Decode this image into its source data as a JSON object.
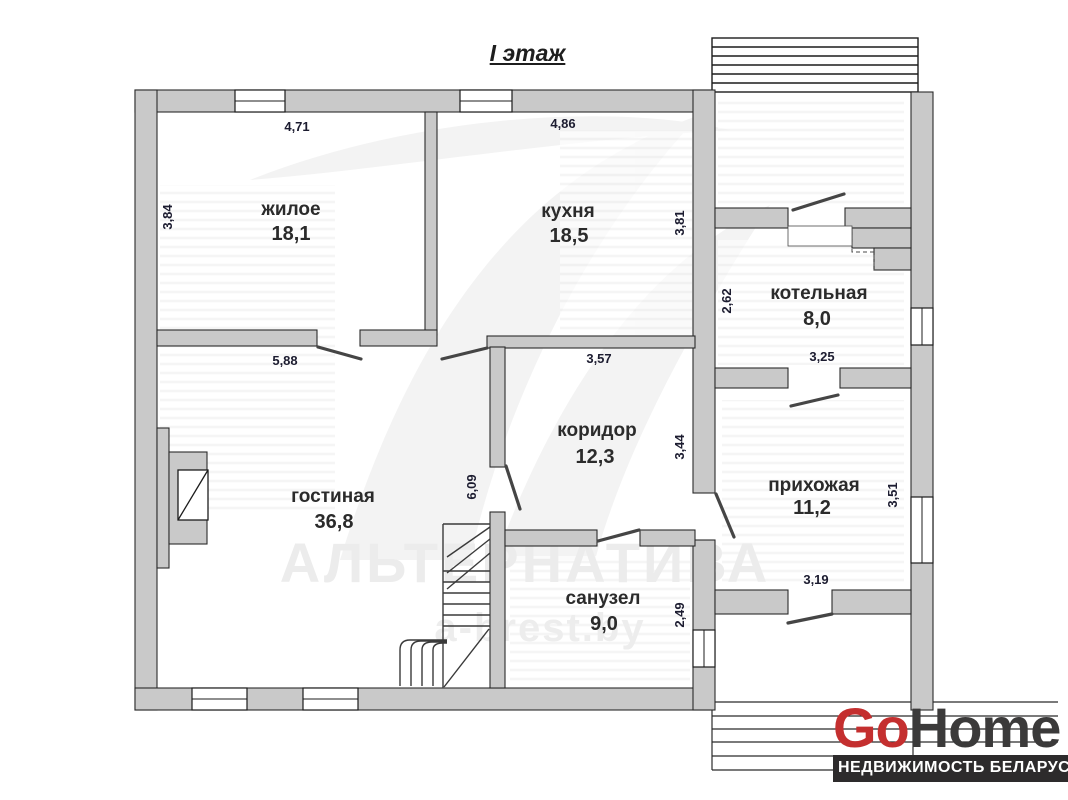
{
  "title": "I этаж",
  "plan": {
    "rooms": [
      {
        "name": "жилое",
        "area": "18,1"
      },
      {
        "name": "кухня",
        "area": "18,5"
      },
      {
        "name": "котельная",
        "area": "8,0"
      },
      {
        "name": "коридор",
        "area": "12,3"
      },
      {
        "name": "гостиная",
        "area": "36,8"
      },
      {
        "name": "прихожая",
        "area": "11,2"
      },
      {
        "name": "санузел",
        "area": "9,0"
      }
    ],
    "dimensions": {
      "zhiloe_width": "4,71",
      "zhiloe_height": "3,84",
      "kuhnya_width": "4,86",
      "kuhnya_height": "3,81",
      "kotelnaya_height": "2,62",
      "kotelnaya_width": "3,25",
      "gostinaya_width": "5,88",
      "gostinaya_height": "6,09",
      "koridor_width": "3,57",
      "koridor_height": "3,44",
      "prihozhaya_height": "3,51",
      "prihozhaya_width": "3,19",
      "sanuzel_height": "2,49"
    }
  },
  "watermark": {
    "brand": "АЛЬТЕРНАТИВА",
    "site": "a-brest.by"
  },
  "logo": {
    "go": "Go",
    "home": "Home",
    "tagline": "НЕДВИЖИМОСТЬ БЕЛАРУСИ"
  },
  "colors": {
    "accent_red": "#c42f2f",
    "wall_fill": "#c9c9c9",
    "banner_dark": "#2d2b2c"
  }
}
